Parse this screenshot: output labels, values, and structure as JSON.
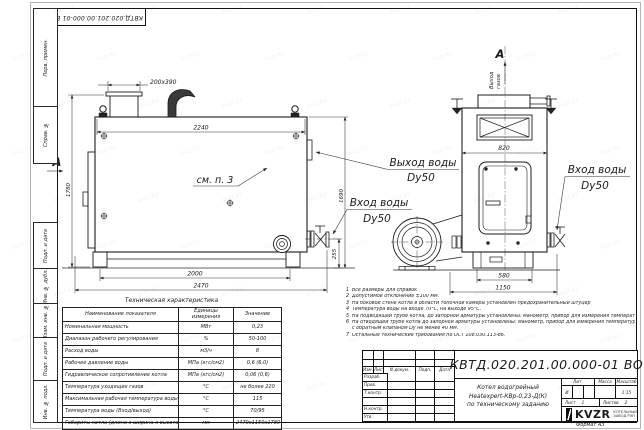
{
  "meta": {
    "watermark": "kvzr.kz",
    "format_label": "Формат А3"
  },
  "stamp_top": {
    "doc_number": "КВТД.020.201.00.000-01 ВО"
  },
  "frame_fields": {
    "f1": "Перв. примен.",
    "f2": "Справ. №",
    "f3": "Подп. и дата",
    "f4": "Инв. № дубл.",
    "f5": "Взам. инв. №",
    "f6": "Подп. и дата",
    "f7": "Инв. № подл."
  },
  "drawing": {
    "section_letter": "А",
    "gas_outlet_line1": "Выход",
    "gas_outlet_line2": "газов",
    "see_note": "см. п. 3",
    "labels": {
      "outlet": "Выход воды",
      "outlet_dy": "Dy50",
      "inlet": "Вход воды",
      "inlet_dy": "Dy50",
      "inlet_right": "Вход воды",
      "inlet_right_dy": "Dy50"
    },
    "dims": {
      "nozzle": "200х390",
      "top_width": "2240",
      "height_left": "1780",
      "height_right": "1690",
      "base_inner": "2000",
      "base_outer": "2470",
      "inlet_height": "255",
      "front_width": "820",
      "front_base_inner": "580",
      "front_base_outer": "1150"
    }
  },
  "notes": {
    "items": [
      {
        "n": "1",
        "text": "Все размеры для справок"
      },
      {
        "n": "2",
        "text": "Допустимое отклонение ±100 мм."
      },
      {
        "n": "3",
        "text": "На боковой стене котла в области топочной камеры установлен предохранительный штуцер"
      },
      {
        "n": "4",
        "text": "Температура воды на входе 70°С, на выходе 95°С."
      },
      {
        "n": "5",
        "text": "На подводящей трубе котла, до запорной арматуры установлены: манометр, прибор для измерения температуры."
      },
      {
        "n": "6",
        "text": "На отводящей трубе котла до запорной арматуры установлены: манометр, прибор для измерения температуры и обвод"
      },
      {
        "n": "",
        "text": "с обратным клапаном Dу не менее 40 мм."
      },
      {
        "n": "7",
        "text": "Остальные технические требования по ОСТ 108.030.113-86."
      }
    ]
  },
  "spec_table": {
    "title": "Техническая характеристика",
    "col_name": "Наименование показателя",
    "col_units": "Единицы измерения",
    "col_value": "Значение",
    "rows": [
      [
        "Номинальная мощность",
        "МВт",
        "0,23"
      ],
      [
        "Диапазон рабочего регулирования",
        "%",
        "50-100"
      ],
      [
        "Расход воды",
        "м3/ч",
        "8"
      ],
      [
        "Рабочее давление воды",
        "МПа (кгс/см2)",
        "0,6 (6,0)"
      ],
      [
        "Гидравлическое сопротивление котла",
        "МПа (кгс/см2)",
        "0,06 (0,6)"
      ],
      [
        "Температура уходящих газов",
        "°С",
        "не более 220"
      ],
      [
        "Максимальная рабочая температура воды",
        "°С",
        "115"
      ],
      [
        "Температура воды (Вход/выход)",
        "°С",
        "70/95"
      ],
      [
        "Габариты котла (длина х ширина х высота)",
        "мм",
        "2470х1150х1780"
      ]
    ]
  },
  "title_block": {
    "doc_number": "КВТД.020.201.00.000-01 ВО",
    "name_line1": "Котел водогрейный",
    "name_line2": "Heatexpert-КВр-0,23-Д(К)",
    "name_line3": "по техническому заданию",
    "col_izm": "Изм.",
    "col_list": "Лист",
    "col_doc": "N докум.",
    "col_podp": "Подп.",
    "col_data": "Дата",
    "row_razrab": "Разраб.",
    "row_prov": "Пров.",
    "row_tkontr": "Т.контр.",
    "row_nkontr": "Н.контр.",
    "row_utv": "Утв.",
    "lit_label": "Лит.",
    "lit_value": "И",
    "mass_label": "Масса",
    "scale_label": "Масштаб",
    "scale_value": "1:15",
    "sheet_label": "Лист",
    "sheet_value": "1",
    "sheets_label": "Листов",
    "sheets_value": "2",
    "logo_text": "KVZR",
    "logo_line1": "КОТЕЛЬНЫЙ",
    "logo_line2": "ЗАВОД РЭП"
  }
}
